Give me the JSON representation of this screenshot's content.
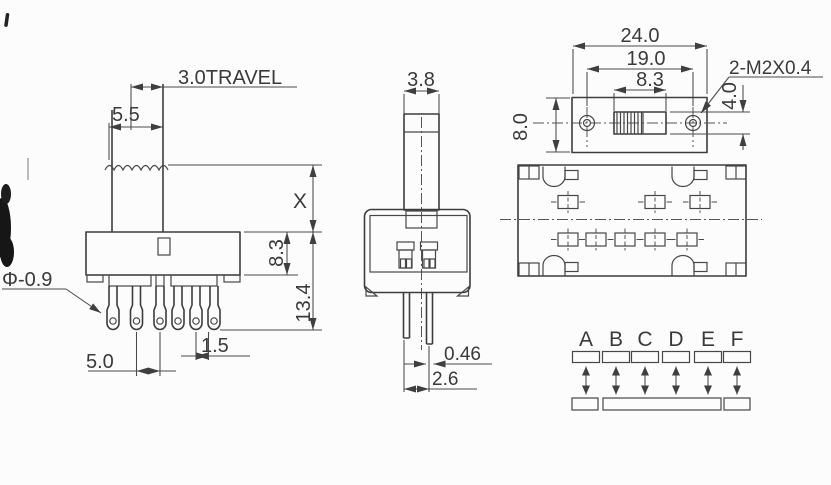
{
  "colors": {
    "line": "#3d3d3d",
    "dimension": "#4a4a4a",
    "text": "#3a3a3a",
    "background": "#fcfcfc",
    "artifact": "#161616"
  },
  "front_view": {
    "travel_label": "3.0TRAVEL",
    "knob_width": "5.5",
    "shaft_height": "X",
    "body_height": "8.3",
    "overall_height": "13.4",
    "pin_hole_dia": "Φ-0.9",
    "pin_span": "5.0",
    "pin_offset": "1.5"
  },
  "side_view": {
    "knob_thickness": "3.8",
    "leg_thickness": "0.46",
    "leg_spacing": "2.6"
  },
  "top_view": {
    "body_length": "24.0",
    "mount_hole_pitch": "19.0",
    "slot_length": "8.3",
    "body_width": "8.0",
    "slot_width": "4.0",
    "mount_hole_spec": "2-M2X0.4"
  },
  "schematic": {
    "positions": [
      "A",
      "B",
      "C",
      "D",
      "E",
      "F"
    ]
  }
}
